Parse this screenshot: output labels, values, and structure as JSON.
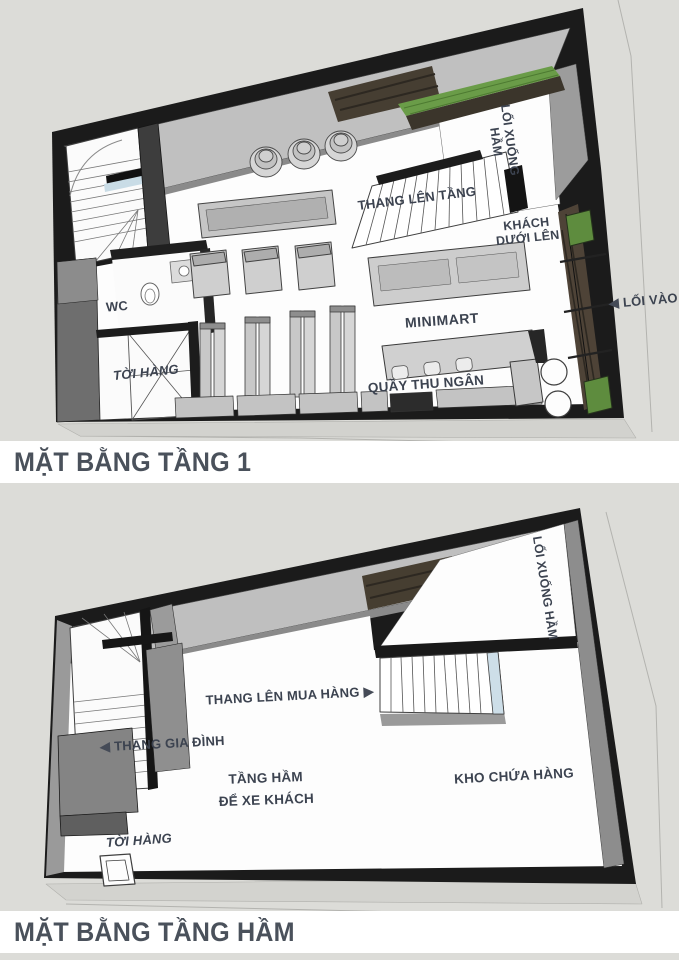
{
  "page": {
    "background_color": "#dcdcd8",
    "title_band_color": "#ffffff",
    "label_text_color": "#3c4350",
    "title_text_color": "#4a515b",
    "wall_color": "#1b1b1b",
    "furniture_color": "#cccccc",
    "planting_color": "#66993f",
    "brick_color": "#4a4135",
    "tread_highlight_color": "#cddee8"
  },
  "floor1": {
    "title": "MẶT BẰNG TẦNG 1",
    "labels": {
      "loi_xuong_ham_line1": "LỐI XUỐNG",
      "loi_xuong_ham_line2": "HẦM",
      "thang_len_tang": "THANG LÊN TẦNG",
      "khach_duoi_len_line1": "KHÁCH",
      "khach_duoi_len_line2": "DƯỚI LÊN",
      "loi_vao": "LỐI VÀO",
      "wc": "WC",
      "toi_hang": "TỜI HÀNG",
      "minimart": "MINIMART",
      "quay_thu_ngan": "QUẦY THU NGÂN"
    },
    "arrows": {
      "loi_vao": "◀"
    }
  },
  "basement": {
    "title": "MẶT BẰNG TẦNG HẦM",
    "labels": {
      "loi_xuong_ham": "LỐI XUỐNG HẦM",
      "thang_len_mua_hang": "THANG LÊN MUA HÀNG",
      "thang_gia_dinh": "THANG GIA ĐÌNH",
      "tang_ham_line1": "TẦNG HẦM",
      "tang_ham_line2": "ĐỂ XE KHÁCH",
      "kho_chua_hang": "KHO CHỨA HÀNG",
      "toi_hang": "TỜI HÀNG"
    },
    "arrows": {
      "thang_len_mua_hang": "▶",
      "thang_gia_dinh": "◀"
    }
  }
}
